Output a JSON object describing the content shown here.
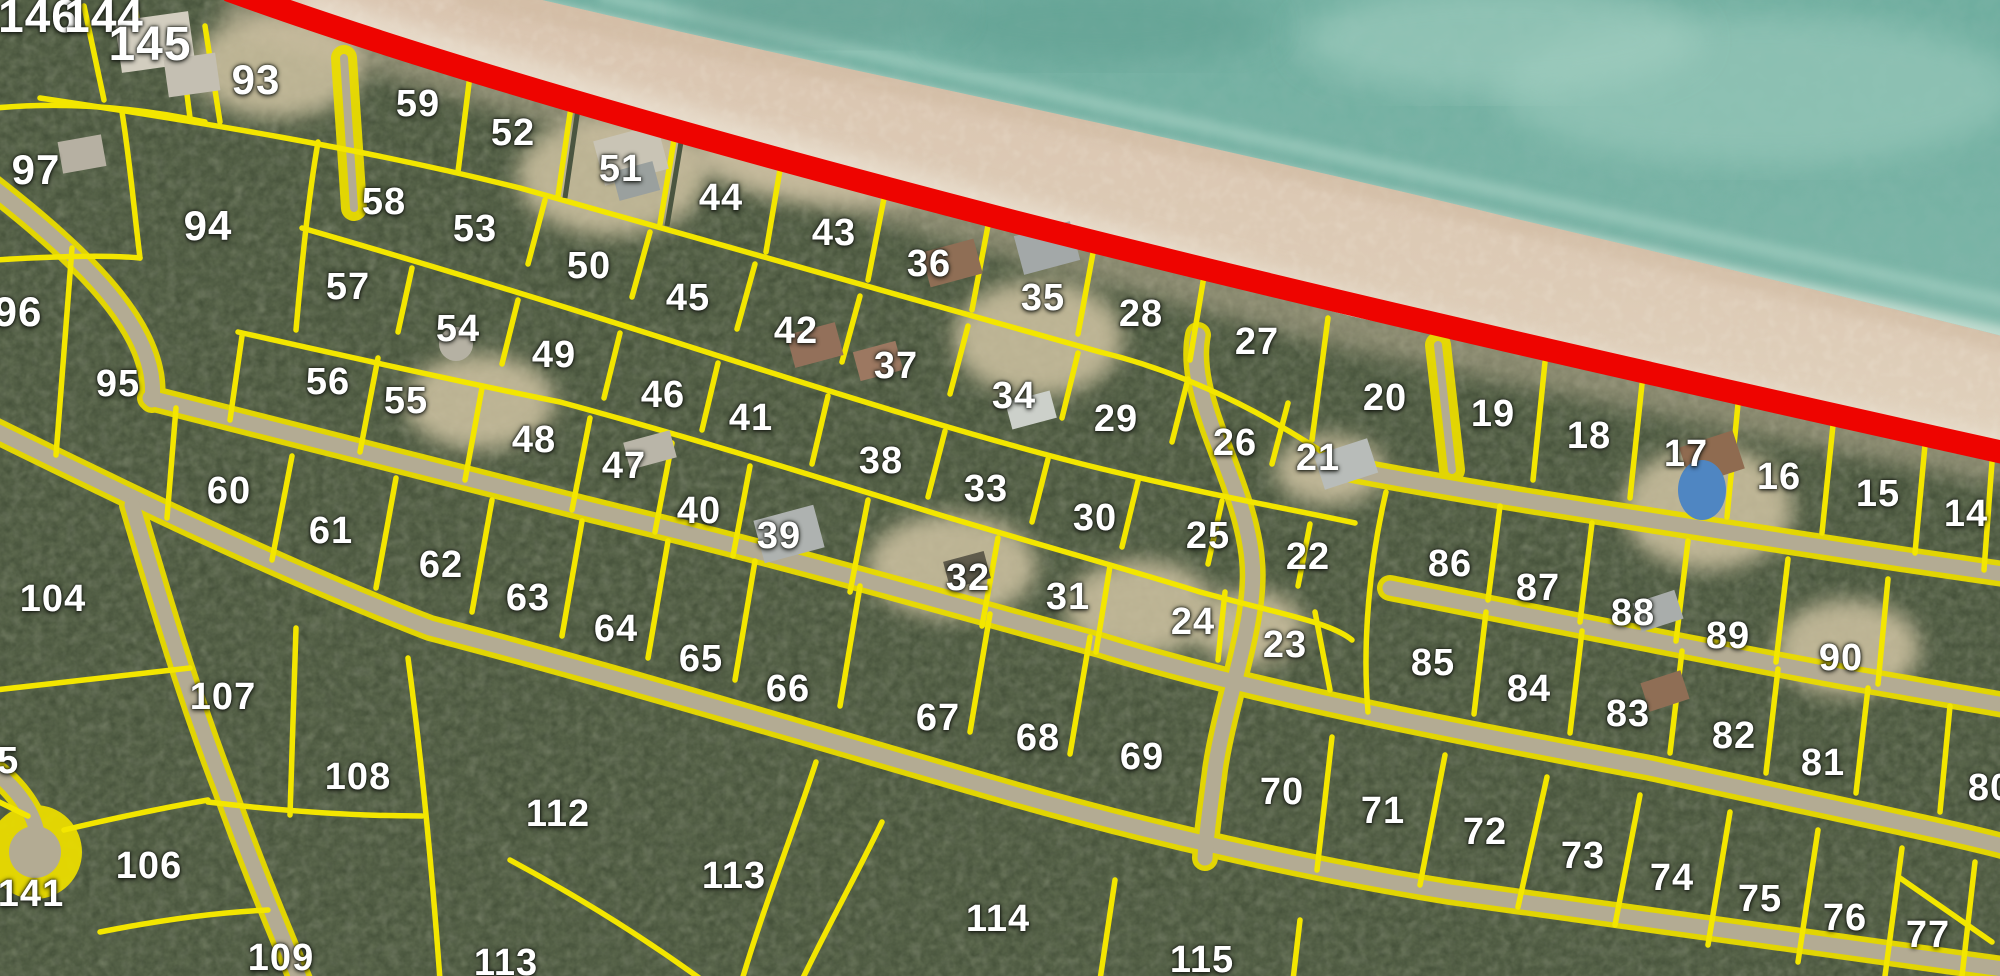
{
  "map": {
    "type": "aerial-plat-map",
    "colors": {
      "lot_line": "#f3e600",
      "boundary_line": "#ee0400",
      "water": "#74b1a3",
      "sand": "#ddd0b8",
      "road": "#b3ab93",
      "land": "#46523b",
      "label_text": "#ffffff"
    },
    "lots": [
      {
        "label": "146",
        "x": 38,
        "y": 16,
        "fs": 46
      },
      {
        "label": "144",
        "x": 104,
        "y": 16,
        "fs": 46
      },
      {
        "label": "145",
        "x": 150,
        "y": 45,
        "fs": 48
      },
      {
        "label": "93",
        "x": 256,
        "y": 80,
        "fs": 42
      },
      {
        "label": "97",
        "x": 36,
        "y": 170,
        "fs": 42
      },
      {
        "label": "94",
        "x": 208,
        "y": 226,
        "fs": 42
      },
      {
        "label": "96",
        "x": 18,
        "y": 312,
        "fs": 42
      },
      {
        "label": "95",
        "x": 118,
        "y": 384
      },
      {
        "label": "59",
        "x": 418,
        "y": 104
      },
      {
        "label": "58",
        "x": 384,
        "y": 202
      },
      {
        "label": "57",
        "x": 348,
        "y": 287
      },
      {
        "label": "56",
        "x": 328,
        "y": 382
      },
      {
        "label": "55",
        "x": 406,
        "y": 401
      },
      {
        "label": "53",
        "x": 475,
        "y": 229
      },
      {
        "label": "54",
        "x": 458,
        "y": 329
      },
      {
        "label": "52",
        "x": 513,
        "y": 133
      },
      {
        "label": "51",
        "x": 621,
        "y": 169
      },
      {
        "label": "50",
        "x": 589,
        "y": 266
      },
      {
        "label": "49",
        "x": 554,
        "y": 355
      },
      {
        "label": "48",
        "x": 534,
        "y": 440
      },
      {
        "label": "47",
        "x": 624,
        "y": 466
      },
      {
        "label": "44",
        "x": 721,
        "y": 198
      },
      {
        "label": "45",
        "x": 688,
        "y": 298
      },
      {
        "label": "46",
        "x": 663,
        "y": 395
      },
      {
        "label": "43",
        "x": 834,
        "y": 233
      },
      {
        "label": "42",
        "x": 796,
        "y": 331
      },
      {
        "label": "41",
        "x": 751,
        "y": 418
      },
      {
        "label": "40",
        "x": 699,
        "y": 511
      },
      {
        "label": "39",
        "x": 779,
        "y": 536
      },
      {
        "label": "38",
        "x": 881,
        "y": 461
      },
      {
        "label": "37",
        "x": 896,
        "y": 366
      },
      {
        "label": "36",
        "x": 929,
        "y": 264
      },
      {
        "label": "35",
        "x": 1043,
        "y": 298
      },
      {
        "label": "34",
        "x": 1014,
        "y": 396
      },
      {
        "label": "33",
        "x": 986,
        "y": 489
      },
      {
        "label": "32",
        "x": 968,
        "y": 578
      },
      {
        "label": "31",
        "x": 1068,
        "y": 597
      },
      {
        "label": "30",
        "x": 1095,
        "y": 518
      },
      {
        "label": "29",
        "x": 1116,
        "y": 419
      },
      {
        "label": "28",
        "x": 1141,
        "y": 314
      },
      {
        "label": "27",
        "x": 1257,
        "y": 342
      },
      {
        "label": "26",
        "x": 1235,
        "y": 443
      },
      {
        "label": "25",
        "x": 1208,
        "y": 536
      },
      {
        "label": "24",
        "x": 1193,
        "y": 622
      },
      {
        "label": "23",
        "x": 1285,
        "y": 645
      },
      {
        "label": "22",
        "x": 1308,
        "y": 557
      },
      {
        "label": "21",
        "x": 1318,
        "y": 458
      },
      {
        "label": "20",
        "x": 1385,
        "y": 398
      },
      {
        "label": "19",
        "x": 1493,
        "y": 414
      },
      {
        "label": "18",
        "x": 1589,
        "y": 436
      },
      {
        "label": "17",
        "x": 1686,
        "y": 454
      },
      {
        "label": "16",
        "x": 1779,
        "y": 477
      },
      {
        "label": "15",
        "x": 1878,
        "y": 494
      },
      {
        "label": "14",
        "x": 1966,
        "y": 514
      },
      {
        "label": "86",
        "x": 1450,
        "y": 564
      },
      {
        "label": "87",
        "x": 1538,
        "y": 588
      },
      {
        "label": "88",
        "x": 1633,
        "y": 613
      },
      {
        "label": "89",
        "x": 1728,
        "y": 636
      },
      {
        "label": "90",
        "x": 1841,
        "y": 658
      },
      {
        "label": "85",
        "x": 1433,
        "y": 663
      },
      {
        "label": "84",
        "x": 1529,
        "y": 689
      },
      {
        "label": "83",
        "x": 1628,
        "y": 714
      },
      {
        "label": "82",
        "x": 1734,
        "y": 736
      },
      {
        "label": "81",
        "x": 1823,
        "y": 763
      },
      {
        "label": "80",
        "x": 1990,
        "y": 788
      },
      {
        "label": "60",
        "x": 229,
        "y": 491
      },
      {
        "label": "61",
        "x": 331,
        "y": 531
      },
      {
        "label": "62",
        "x": 441,
        "y": 565
      },
      {
        "label": "63",
        "x": 528,
        "y": 598
      },
      {
        "label": "64",
        "x": 616,
        "y": 629
      },
      {
        "label": "65",
        "x": 701,
        "y": 659
      },
      {
        "label": "66",
        "x": 788,
        "y": 689
      },
      {
        "label": "67",
        "x": 938,
        "y": 718
      },
      {
        "label": "68",
        "x": 1038,
        "y": 738
      },
      {
        "label": "69",
        "x": 1142,
        "y": 757
      },
      {
        "label": "70",
        "x": 1282,
        "y": 792
      },
      {
        "label": "71",
        "x": 1383,
        "y": 811
      },
      {
        "label": "72",
        "x": 1485,
        "y": 832
      },
      {
        "label": "73",
        "x": 1583,
        "y": 856
      },
      {
        "label": "74",
        "x": 1672,
        "y": 878
      },
      {
        "label": "75",
        "x": 1760,
        "y": 899
      },
      {
        "label": "76",
        "x": 1845,
        "y": 918
      },
      {
        "label": "77",
        "x": 1928,
        "y": 935
      },
      {
        "label": "104",
        "x": 53,
        "y": 599
      },
      {
        "label": "105",
        "x": -14,
        "y": 761
      },
      {
        "label": "107",
        "x": 223,
        "y": 697
      },
      {
        "label": "108",
        "x": 358,
        "y": 777
      },
      {
        "label": "106",
        "x": 149,
        "y": 866
      },
      {
        "label": "141",
        "x": 31,
        "y": 894
      },
      {
        "label": "109",
        "x": 281,
        "y": 958
      },
      {
        "label": "112",
        "x": 558,
        "y": 814
      },
      {
        "label": "113",
        "x": 734,
        "y": 876
      },
      {
        "label": "113",
        "x": 506,
        "y": 963
      },
      {
        "label": "114",
        "x": 998,
        "y": 919
      },
      {
        "label": "115",
        "x": 1202,
        "y": 960
      }
    ]
  }
}
